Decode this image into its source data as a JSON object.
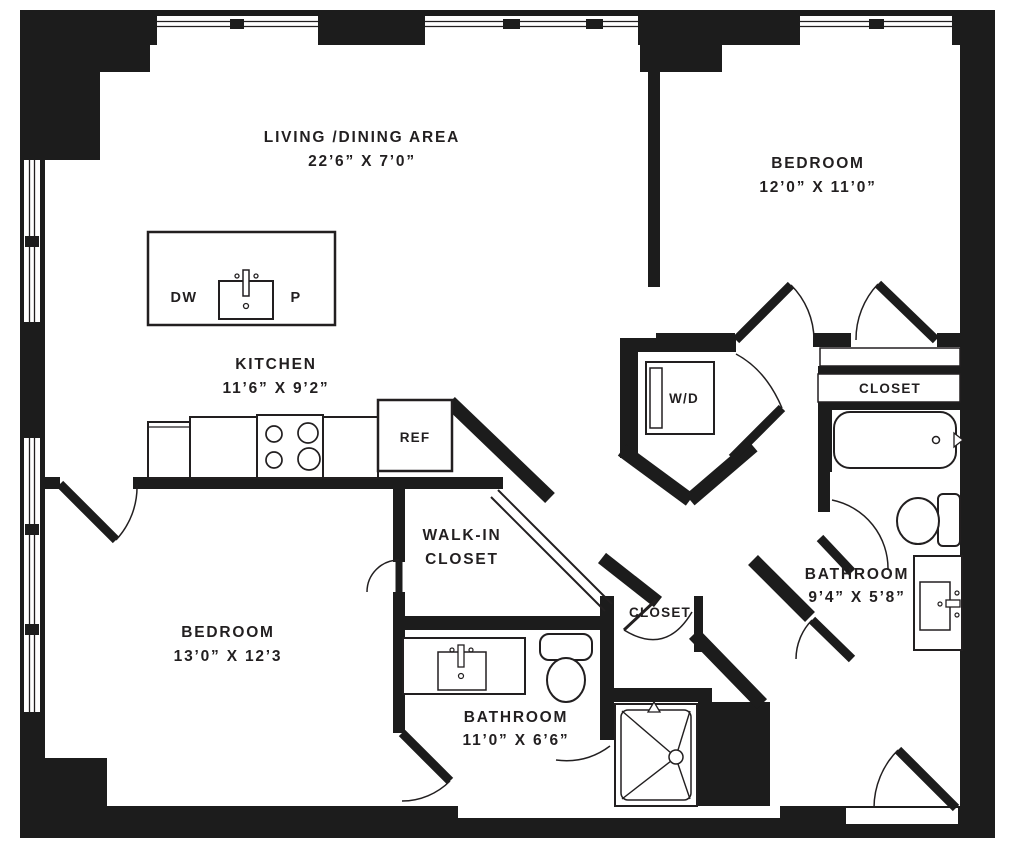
{
  "rooms": {
    "living": {
      "name": "LIVING /DINING AREA",
      "dims": "22’6” X 7’0”"
    },
    "kitchen": {
      "name": "KITCHEN",
      "dims": "11’6” X 9’2”"
    },
    "bedroom_top_right": {
      "name": "BEDROOM",
      "dims": "12’0” X 11’0”"
    },
    "bedroom_bottom_left": {
      "name": "BEDROOM",
      "dims": "13’0” X 12’3"
    },
    "bathroom_right": {
      "name": "BATHROOM",
      "dims": "9’4” X 5’8”"
    },
    "bathroom_bottom": {
      "name": "BATHROOM",
      "dims": "11’0” X 6’6”"
    },
    "walk_in_closet": {
      "name_line1": "WALK-IN",
      "name_line2": "CLOSET"
    },
    "closet_top_right": {
      "name": "CLOSET"
    },
    "closet_center": {
      "name": "CLOSET"
    }
  },
  "fixtures": {
    "washer_dryer": "W/D",
    "dishwasher": "DW",
    "pantry": "P",
    "refrigerator": "REF"
  },
  "colors": {
    "wall": "#1c1c1c",
    "floor": "#ffffff",
    "line": "#221f20"
  }
}
